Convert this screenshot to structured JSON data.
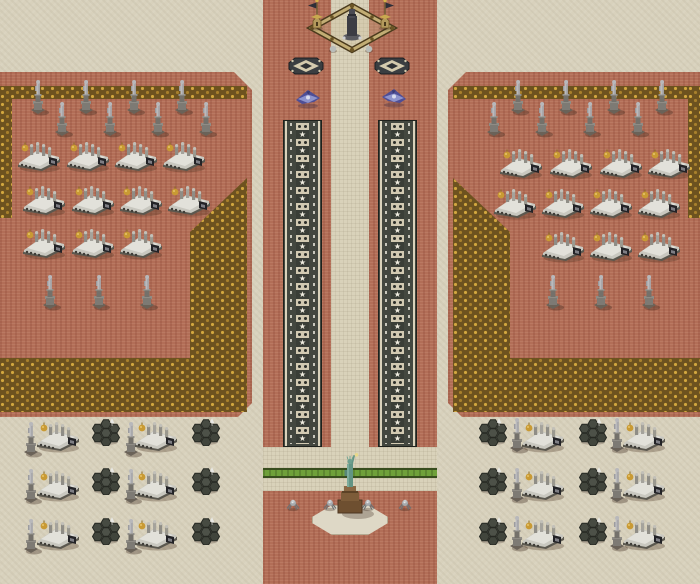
{
  "meta": {
    "title": "isometric-rts-map",
    "width": 700,
    "height": 584
  },
  "colors": {
    "sand": "#d8d1bc",
    "brick": "#b26e57",
    "gold_trim": "#c8a040",
    "gold_base": "#6d521f",
    "road_dark": "#43473f",
    "road_stripe": "#d2cab2",
    "star_white": "#f0ede0",
    "grass_green": "#6fa03a",
    "pave_tan": "#d9d2ba",
    "statue_gray": "#a9a9ac",
    "vehicle_white": "#c9c8c0",
    "dome_gold": "#c99a33",
    "jet_purple": "#4e4e96",
    "liberty_teal": "#629484",
    "pedestal_brown": "#6e4f30",
    "hex_dark": "#474b42"
  },
  "terrain": {
    "regions": [
      {
        "name": "sand-background",
        "type": "sand",
        "x": 0,
        "y": 0,
        "w": 700,
        "h": 584
      },
      {
        "name": "center-corridor",
        "type": "brick",
        "x": 263,
        "y": 0,
        "w": 174,
        "h": 584
      },
      {
        "name": "left-platform",
        "type": "brick",
        "x": 0,
        "y": 72,
        "w": 252,
        "h": 345,
        "clip": "polygon(0px 0px, 234px 0px, 252px 18px, 252px 331px, 238px 345px, 0px 345px)"
      },
      {
        "name": "right-platform",
        "type": "brick",
        "x": 448,
        "y": 72,
        "w": 252,
        "h": 345,
        "clip": "polygon(18px 0px, 252px 0px, 252px 345px, 14px 345px, 0px 331px, 0px 18px)"
      },
      {
        "name": "left-gold-top-border",
        "type": "gold",
        "x": 10,
        "y": 86,
        "w": 237,
        "h": 13
      },
      {
        "name": "left-gold-edge-border",
        "type": "gold",
        "x": 0,
        "y": 86,
        "w": 12,
        "h": 132
      },
      {
        "name": "left-gold-corner",
        "type": "gold",
        "x": 0,
        "y": 178,
        "w": 247,
        "h": 234,
        "clip": "polygon(247px 0px, 247px 234px, 0px 234px, 0px 180px, 190px 180px, 190px 54px)"
      },
      {
        "name": "right-gold-top-border",
        "type": "gold",
        "x": 453,
        "y": 86,
        "w": 237,
        "h": 13
      },
      {
        "name": "right-gold-edge-border",
        "type": "gold",
        "x": 688,
        "y": 86,
        "w": 12,
        "h": 132
      },
      {
        "name": "right-gold-corner",
        "type": "gold",
        "x": 453,
        "y": 178,
        "w": 247,
        "h": 234,
        "clip": "polygon(0px 0px, 0px 234px, 247px 234px, 247px 180px, 57px 180px, 57px 54px)"
      },
      {
        "name": "center-path",
        "type": "pave",
        "x": 331,
        "y": 0,
        "w": 38,
        "h": 468
      },
      {
        "name": "plaza-band-top",
        "type": "pave",
        "x": 263,
        "y": 447,
        "w": 174,
        "h": 21
      },
      {
        "name": "green-strip",
        "type": "grass",
        "x": 263,
        "y": 468,
        "w": 174,
        "h": 10
      },
      {
        "name": "plaza-band-bottom",
        "type": "pave",
        "x": 263,
        "y": 478,
        "w": 174,
        "h": 13
      },
      {
        "name": "liberty-pad",
        "type": "pad",
        "x": 312,
        "y": 505,
        "w": 76,
        "h": 30,
        "clip": "polygon(20px 0px, 56px 0px, 76px 12px, 76px 18px, 56px 30px, 20px 30px, 0px 18px, 0px 12px)"
      }
    ]
  },
  "roads": [
    {
      "name": "left-star-road",
      "x": 283,
      "y": 120,
      "w": 39,
      "h": 327,
      "segments": 20
    },
    {
      "name": "right-star-road",
      "x": 378,
      "y": 120,
      "w": 39,
      "h": 327,
      "segments": 20
    }
  ],
  "structures": {
    "fort": {
      "x": 304,
      "y": -2
    },
    "flag_towers": [
      {
        "x": 317,
        "y": 16,
        "dir": "left"
      },
      {
        "x": 385,
        "y": 16,
        "dir": "right"
      }
    ],
    "liberty": {
      "x": 312,
      "y": 452
    }
  },
  "units": {
    "diamond_tiles": [
      {
        "x": 306,
        "y": 68
      },
      {
        "x": 392,
        "y": 68
      }
    ],
    "jets": [
      {
        "x": 308,
        "y": 100,
        "dir": "left"
      },
      {
        "x": 394,
        "y": 99,
        "dir": "right"
      }
    ],
    "statues": [
      {
        "x": 38,
        "y": 120
      },
      {
        "x": 86,
        "y": 120
      },
      {
        "x": 134,
        "y": 120
      },
      {
        "x": 182,
        "y": 120
      },
      {
        "x": 62,
        "y": 142
      },
      {
        "x": 110,
        "y": 142
      },
      {
        "x": 158,
        "y": 142
      },
      {
        "x": 206,
        "y": 142
      },
      {
        "x": 50,
        "y": 315
      },
      {
        "x": 99,
        "y": 315
      },
      {
        "x": 147,
        "y": 315
      },
      {
        "x": 518,
        "y": 120
      },
      {
        "x": 566,
        "y": 120
      },
      {
        "x": 614,
        "y": 120
      },
      {
        "x": 662,
        "y": 120
      },
      {
        "x": 494,
        "y": 142
      },
      {
        "x": 542,
        "y": 142
      },
      {
        "x": 590,
        "y": 142
      },
      {
        "x": 638,
        "y": 142
      },
      {
        "x": 553,
        "y": 315
      },
      {
        "x": 601,
        "y": 315
      },
      {
        "x": 649,
        "y": 315
      },
      {
        "x": 31,
        "y": 462
      },
      {
        "x": 131,
        "y": 462
      },
      {
        "x": 31,
        "y": 509
      },
      {
        "x": 131,
        "y": 509
      },
      {
        "x": 31,
        "y": 559
      },
      {
        "x": 131,
        "y": 559
      },
      {
        "x": 517,
        "y": 458
      },
      {
        "x": 617,
        "y": 458
      },
      {
        "x": 517,
        "y": 508
      },
      {
        "x": 617,
        "y": 508
      },
      {
        "x": 517,
        "y": 556
      },
      {
        "x": 617,
        "y": 556
      }
    ],
    "vehicles": [
      {
        "x": 38,
        "y": 158
      },
      {
        "x": 87,
        "y": 158
      },
      {
        "x": 135,
        "y": 158
      },
      {
        "x": 183,
        "y": 158
      },
      {
        "x": 43,
        "y": 202
      },
      {
        "x": 92,
        "y": 202
      },
      {
        "x": 140,
        "y": 202
      },
      {
        "x": 188,
        "y": 202
      },
      {
        "x": 43,
        "y": 245
      },
      {
        "x": 92,
        "y": 245
      },
      {
        "x": 140,
        "y": 245
      },
      {
        "x": 520,
        "y": 165
      },
      {
        "x": 570,
        "y": 165
      },
      {
        "x": 620,
        "y": 165
      },
      {
        "x": 668,
        "y": 165
      },
      {
        "x": 514,
        "y": 205
      },
      {
        "x": 562,
        "y": 205
      },
      {
        "x": 610,
        "y": 205
      },
      {
        "x": 658,
        "y": 205
      },
      {
        "x": 562,
        "y": 248
      },
      {
        "x": 610,
        "y": 248
      },
      {
        "x": 658,
        "y": 248
      },
      {
        "x": 57,
        "y": 438
      },
      {
        "x": 155,
        "y": 438
      },
      {
        "x": 57,
        "y": 487
      },
      {
        "x": 155,
        "y": 487
      },
      {
        "x": 57,
        "y": 536
      },
      {
        "x": 155,
        "y": 536
      },
      {
        "x": 542,
        "y": 438
      },
      {
        "x": 643,
        "y": 438
      },
      {
        "x": 542,
        "y": 487
      },
      {
        "x": 643,
        "y": 487
      },
      {
        "x": 542,
        "y": 536
      },
      {
        "x": 643,
        "y": 536
      }
    ],
    "clusters": [
      {
        "x": 106,
        "y": 434
      },
      {
        "x": 206,
        "y": 434
      },
      {
        "x": 106,
        "y": 483
      },
      {
        "x": 206,
        "y": 483
      },
      {
        "x": 106,
        "y": 533
      },
      {
        "x": 206,
        "y": 533
      },
      {
        "x": 493,
        "y": 434
      },
      {
        "x": 593,
        "y": 434
      },
      {
        "x": 493,
        "y": 483
      },
      {
        "x": 593,
        "y": 483
      },
      {
        "x": 493,
        "y": 533
      },
      {
        "x": 593,
        "y": 533
      }
    ],
    "drones": [
      {
        "x": 293,
        "y": 506
      },
      {
        "x": 330,
        "y": 506
      },
      {
        "x": 368,
        "y": 506
      },
      {
        "x": 405,
        "y": 506
      }
    ]
  }
}
